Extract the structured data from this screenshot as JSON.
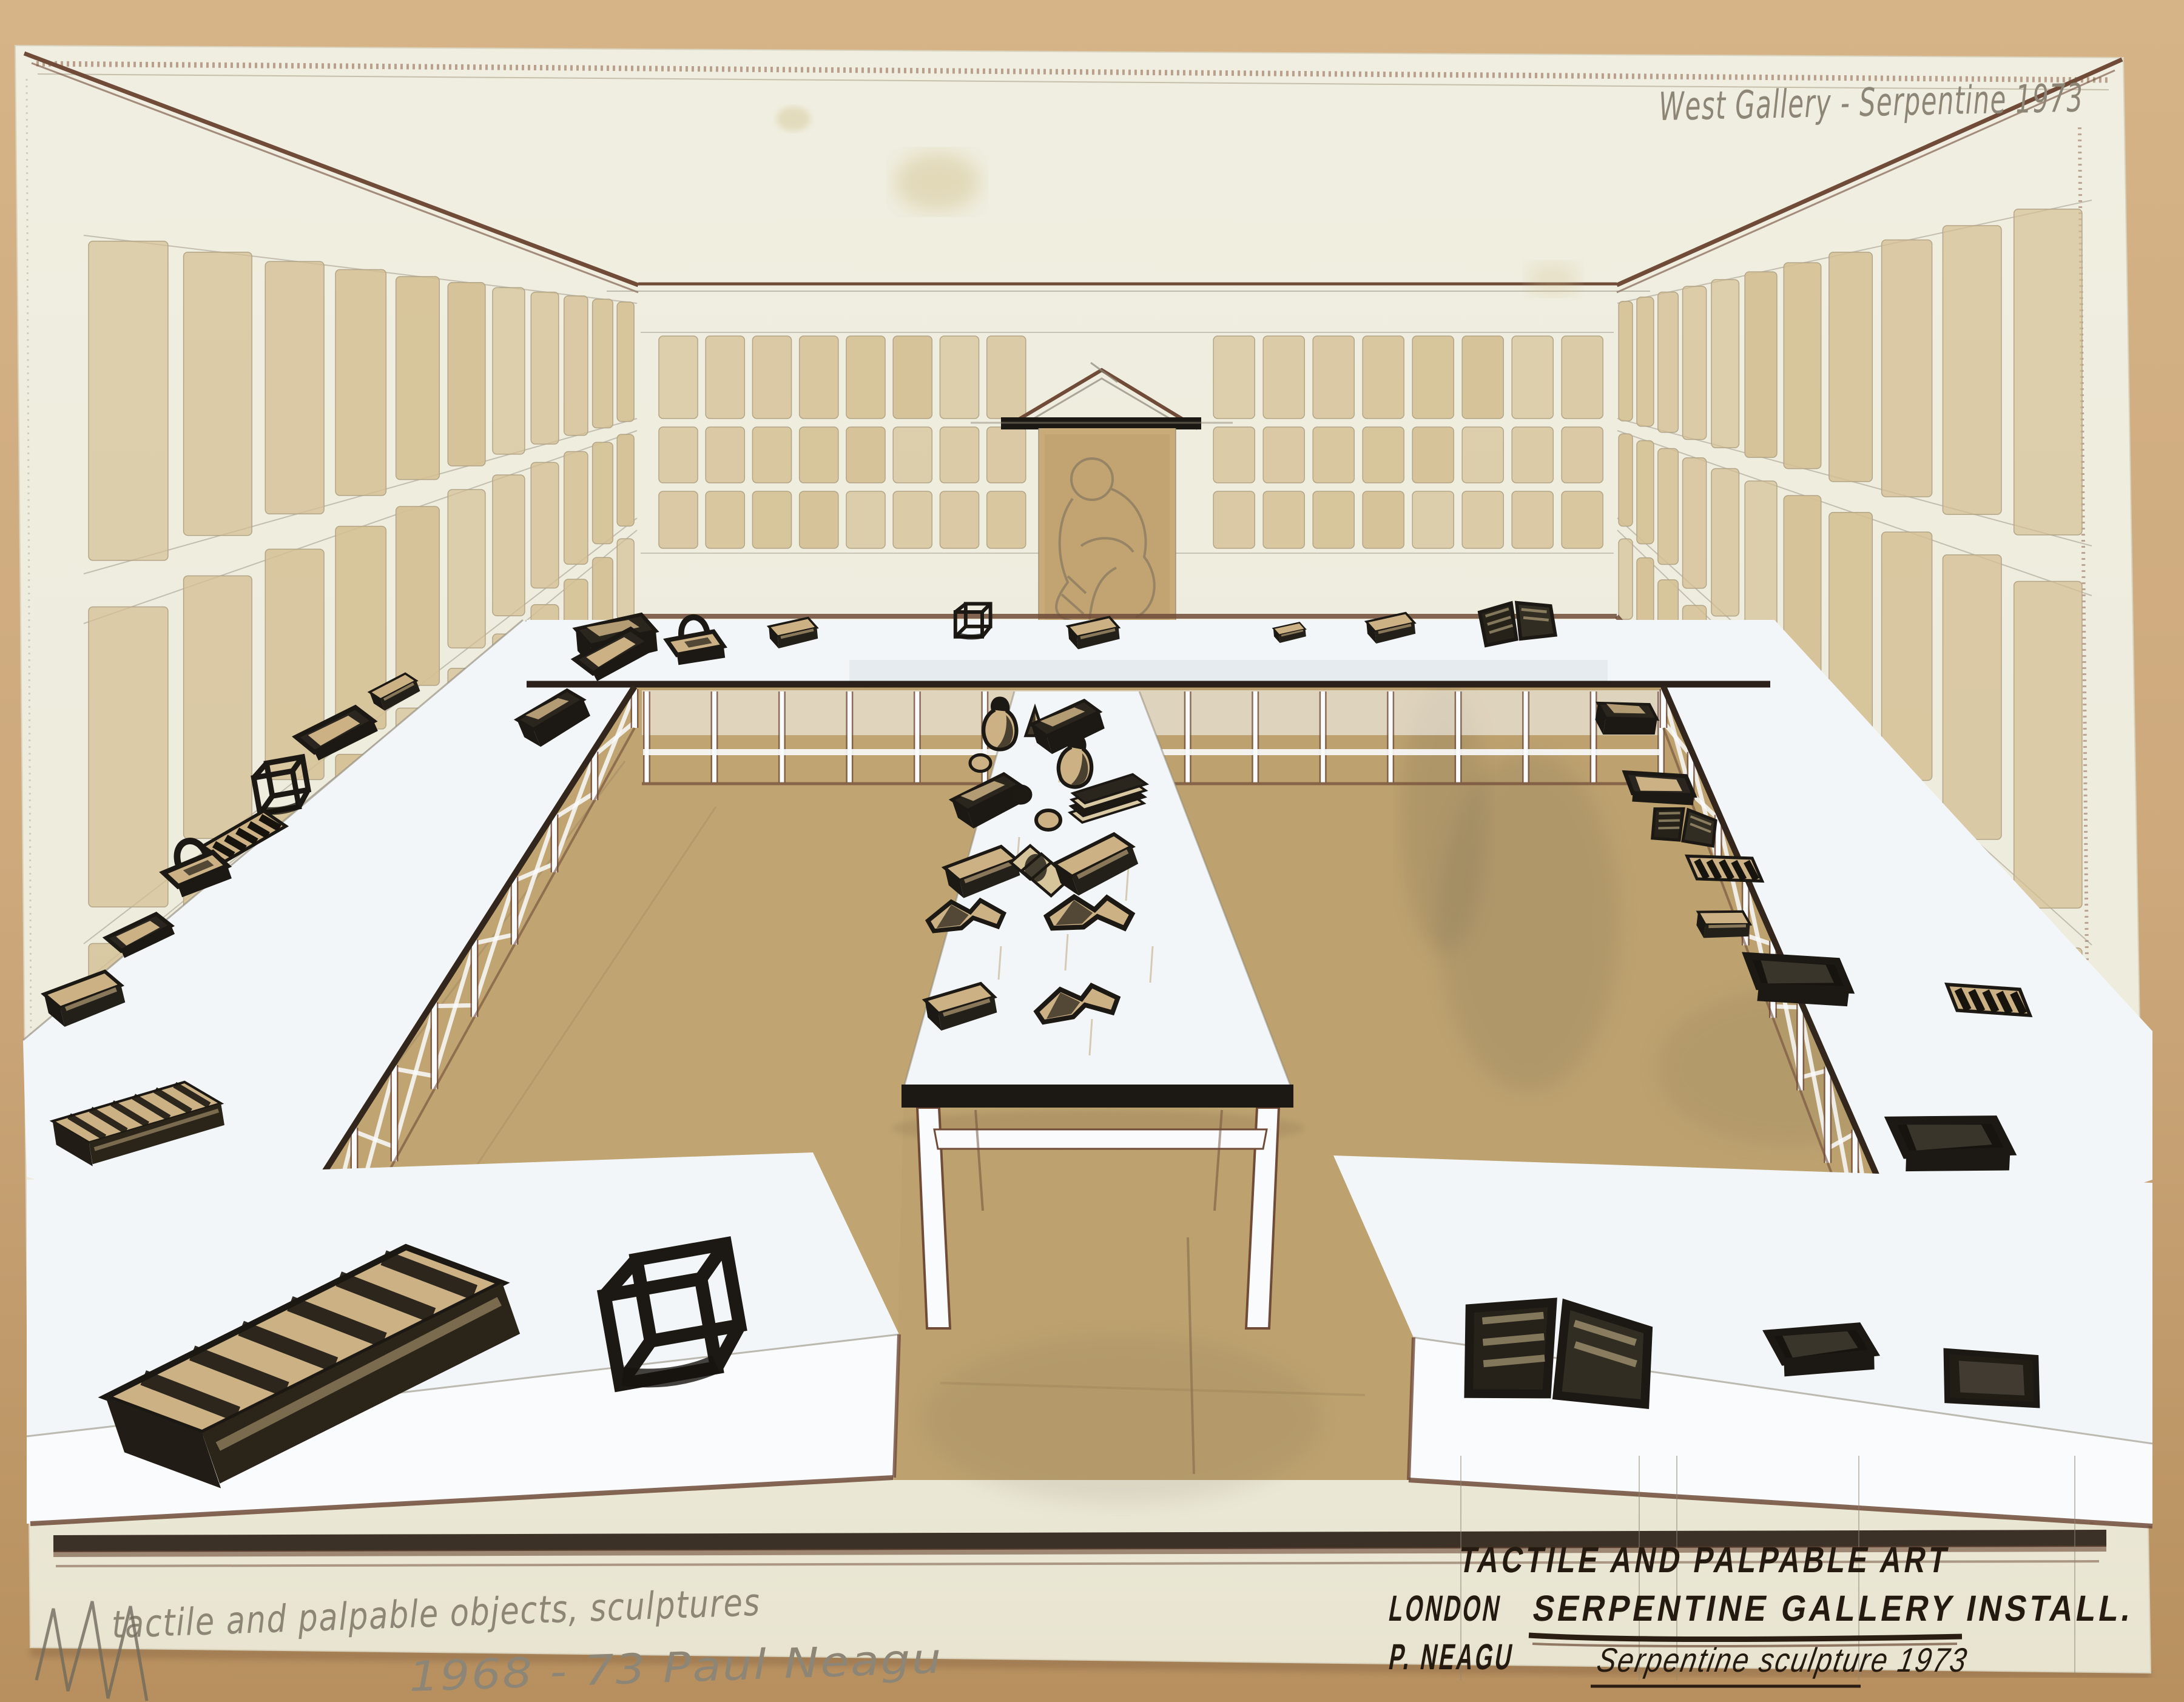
{
  "annotations": {
    "top_right": "West Gallery - Serpentine 1973",
    "bottom_left_line1": "tactile and palpable objects, sculptures",
    "bottom_left_line2": "1968 - 73   Paul Neagu",
    "caption_title": "TACTILE AND PALPABLE ART",
    "caption_city": "LONDON",
    "caption_gallery": "SERPENTINE GALLERY INSTALL.",
    "caption_artist": "P. NEAGU",
    "caption_subtitle": "Serpentine sculpture 1973"
  },
  "palette": {
    "mat": "#cfab7e",
    "matdark": "#b8915f",
    "paper": "#edebdb",
    "panel": "#d4bf93",
    "paneledge": "#b3a587",
    "tan": "#cbb184",
    "floor": "#bda26f",
    "floordark": "#7d7058",
    "ink": "#1c1813",
    "brown": "#6f4b38",
    "pencil": "#8d8676",
    "table": "#f3f6f8",
    "tableshadow": "#ccd7df",
    "white": "#fafbfc"
  }
}
